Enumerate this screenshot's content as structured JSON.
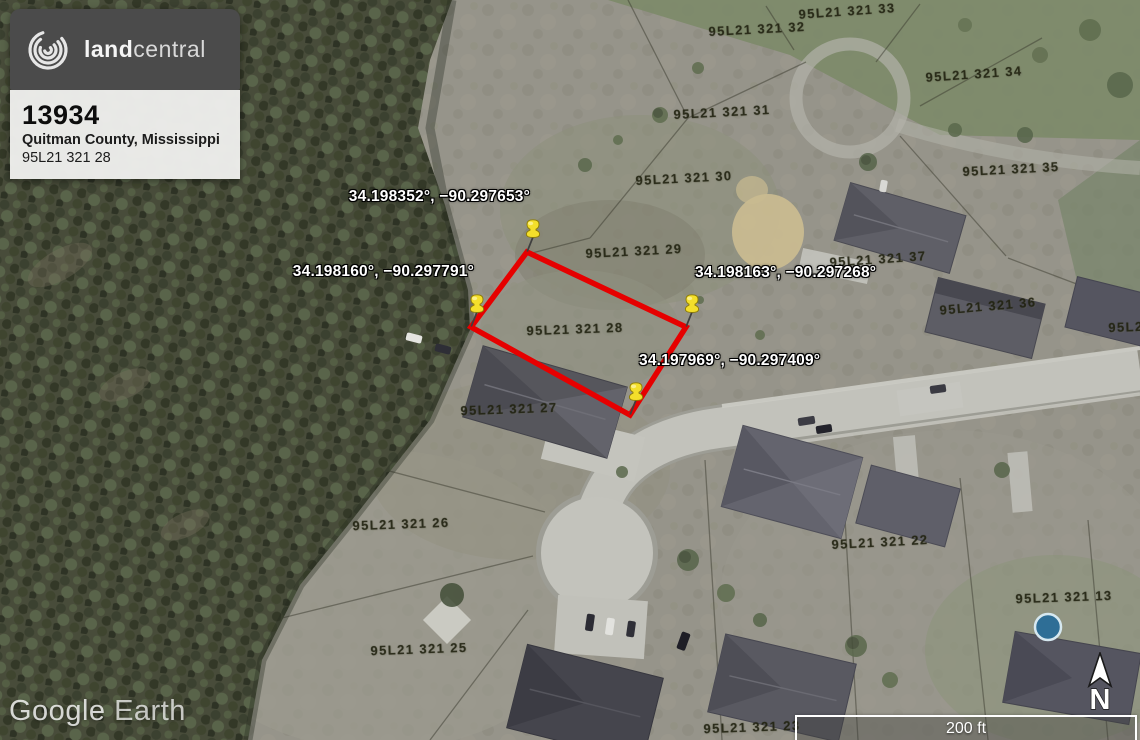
{
  "app": {
    "watermark_primary": "Google",
    "watermark_secondary": "Earth"
  },
  "listing_card": {
    "brand_bold": "land",
    "brand_light": "central",
    "listing_id": "13934",
    "county": "Quitman County, Mississippi",
    "parcel_number": "95L21 321 28"
  },
  "map": {
    "controls": {
      "north_label": "N",
      "scale_label": "200 ft"
    },
    "parcel_outline": {
      "color": "#e60000",
      "points": "527,252 686,327 630,415 471,327"
    },
    "pins": [
      {
        "name": "pin-northwest-corner",
        "coords": "34.198352°, −90.297653°",
        "x": 527,
        "y": 252,
        "side": "left"
      },
      {
        "name": "pin-west-corner",
        "coords": "34.198160°, −90.297791°",
        "x": 471,
        "y": 327,
        "side": "left"
      },
      {
        "name": "pin-east-corner",
        "coords": "34.198163°, −90.297268°",
        "x": 686,
        "y": 327,
        "side": "right"
      },
      {
        "name": "pin-south-corner",
        "coords": "34.197969°, −90.297409°",
        "x": 630,
        "y": 415,
        "side": "right"
      }
    ],
    "parcel_labels": [
      {
        "text": "95L21 321  32",
        "x": 757,
        "y": 29,
        "rot": -3
      },
      {
        "text": "95L21 321  33",
        "x": 847,
        "y": 11,
        "rot": -4
      },
      {
        "text": "95L21 321  34",
        "x": 974,
        "y": 74,
        "rot": -4
      },
      {
        "text": "95L21 321  31",
        "x": 722,
        "y": 112,
        "rot": -3
      },
      {
        "text": "95L21 321  35",
        "x": 1011,
        "y": 169,
        "rot": -3
      },
      {
        "text": "95L21 321  30",
        "x": 684,
        "y": 178,
        "rot": -3
      },
      {
        "text": "95L21 321  29",
        "x": 634,
        "y": 251,
        "rot": -3
      },
      {
        "text": "95L21 321  37",
        "x": 878,
        "y": 259,
        "rot": -4
      },
      {
        "text": "95L21 321  36",
        "x": 988,
        "y": 306,
        "rot": -5
      },
      {
        "text": "95L2",
        "x": 1126,
        "y": 327,
        "rot": -2
      },
      {
        "text": "95L21 321  28",
        "x": 575,
        "y": 329,
        "rot": -2
      },
      {
        "text": "95L21 321  27",
        "x": 509,
        "y": 409,
        "rot": -2
      },
      {
        "text": "95L21 321  26",
        "x": 401,
        "y": 524,
        "rot": -2
      },
      {
        "text": "95L21 321  22",
        "x": 880,
        "y": 542,
        "rot": -3
      },
      {
        "text": "95L21 321  13",
        "x": 1064,
        "y": 597,
        "rot": -2
      },
      {
        "text": "95L21 321  25",
        "x": 419,
        "y": 649,
        "rot": -2
      },
      {
        "text": "95L21 321  23",
        "x": 752,
        "y": 727,
        "rot": -2
      }
    ]
  }
}
